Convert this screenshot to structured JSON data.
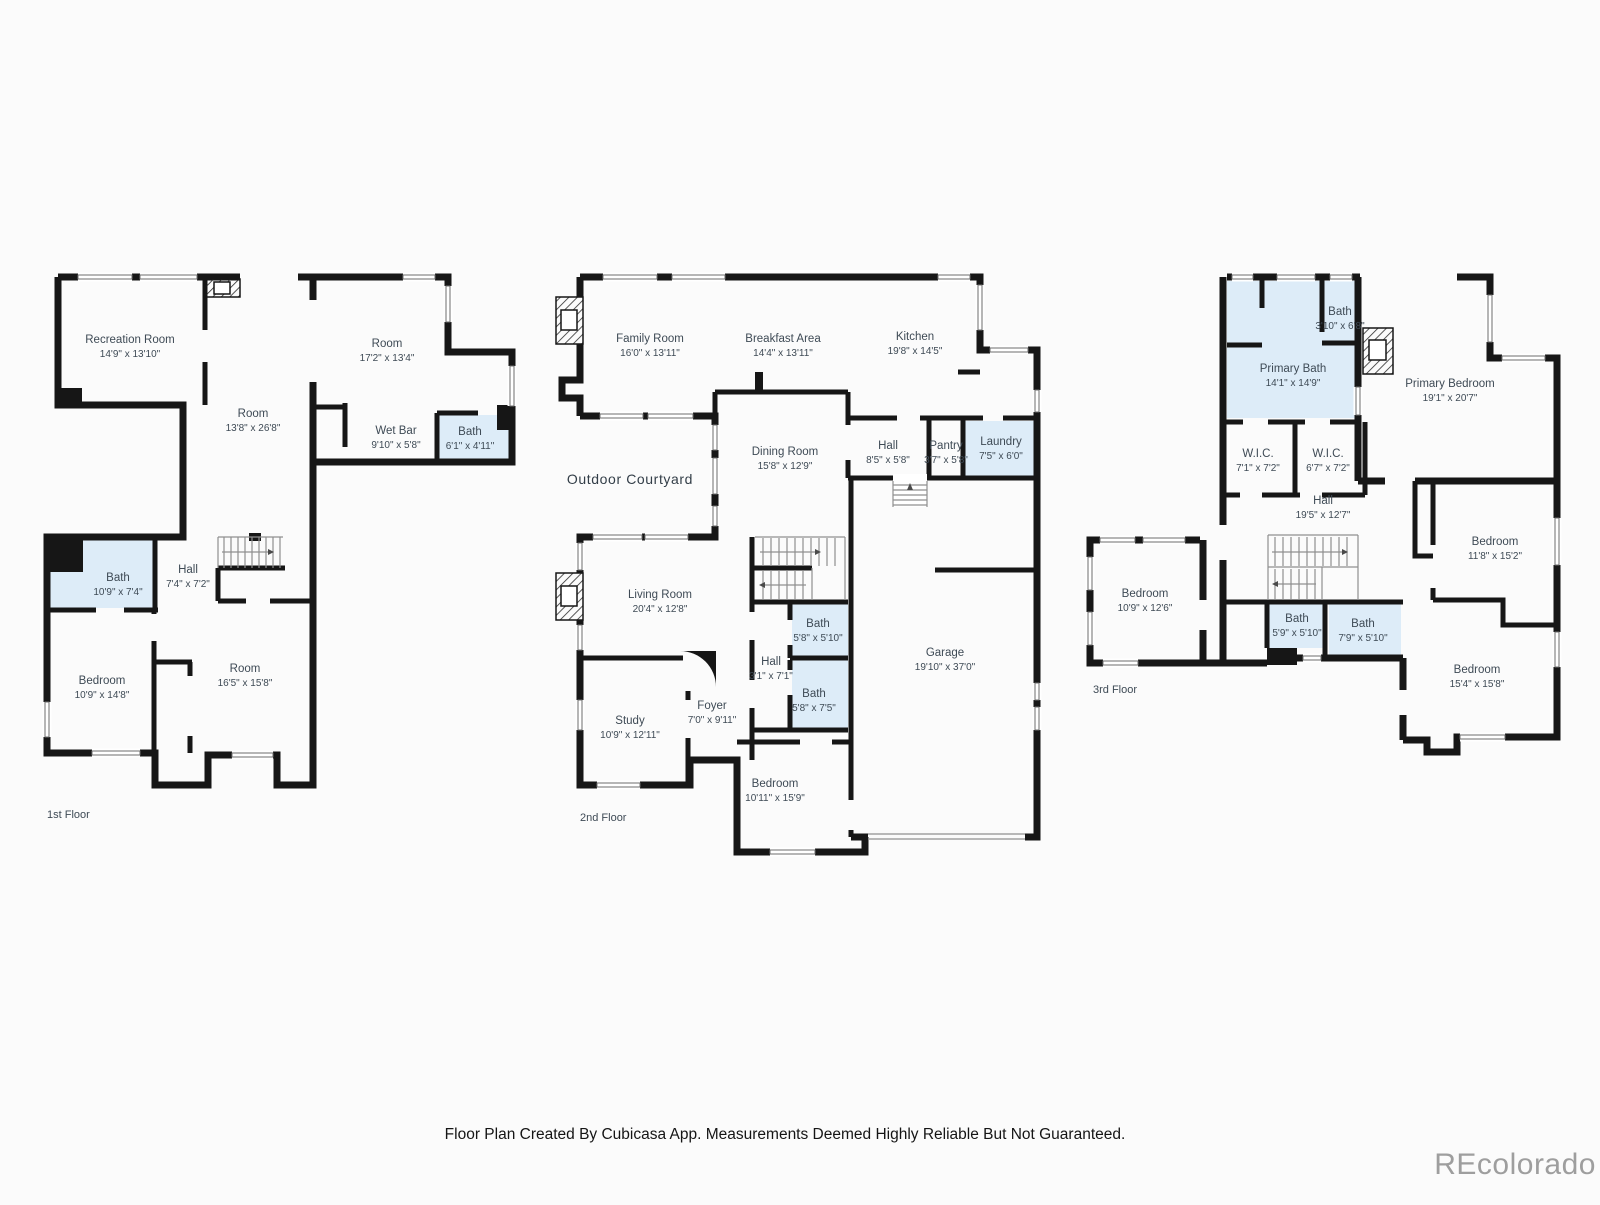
{
  "colors": {
    "wall": "#161616",
    "wet_room_fill": "#ddecf8",
    "label_text": "#3e4a55",
    "watermark_gray": "#9e9e9e",
    "background": "#fbfbfb"
  },
  "floors": [
    {
      "label": "1st Floor",
      "rooms": [
        {
          "name": "Recreation Room",
          "dims": "14'9\" x 13'10\""
        },
        {
          "name": "Room",
          "dims": "13'8\" x 26'8\""
        },
        {
          "name": "Room",
          "dims": "17'2\" x 13'4\""
        },
        {
          "name": "Wet Bar",
          "dims": "9'10\" x 5'8\""
        },
        {
          "name": "Bath",
          "dims": "6'1\" x 4'11\""
        },
        {
          "name": "Bath",
          "dims": "10'9\" x 7'4\""
        },
        {
          "name": "Hall",
          "dims": "7'4\" x 7'2\""
        },
        {
          "name": "Bedroom",
          "dims": "10'9\" x 14'8\""
        },
        {
          "name": "Room",
          "dims": "16'5\" x 15'8\""
        }
      ]
    },
    {
      "label": "2nd Floor",
      "rooms": [
        {
          "name": "Family Room",
          "dims": "16'0\" x 13'11\""
        },
        {
          "name": "Breakfast Area",
          "dims": "14'4\" x 13'11\""
        },
        {
          "name": "Kitchen",
          "dims": "19'8\" x 14'5\""
        },
        {
          "name": "Hall",
          "dims": "8'5\" x 5'8\""
        },
        {
          "name": "Pantry",
          "dims": "3'7\" x 5'8\""
        },
        {
          "name": "Laundry",
          "dims": "7'5\" x 6'0\""
        },
        {
          "name": "Outdoor Courtyard"
        },
        {
          "name": "Dining Room",
          "dims": "15'8\" x 12'9\""
        },
        {
          "name": "Living Room",
          "dims": "20'4\" x 12'8\""
        },
        {
          "name": "Bath",
          "dims": "5'8\" x 5'10\""
        },
        {
          "name": "Hall",
          "dims": "3'1\" x 7'1\""
        },
        {
          "name": "Bath",
          "dims": "5'8\" x 7'5\""
        },
        {
          "name": "Garage",
          "dims": "19'10\" x 37'0\""
        },
        {
          "name": "Study",
          "dims": "10'9\" x 12'11\""
        },
        {
          "name": "Foyer",
          "dims": "7'0\" x 9'11\""
        },
        {
          "name": "Bedroom",
          "dims": "10'11\" x 15'9\""
        }
      ]
    },
    {
      "label": "3rd Floor",
      "rooms": [
        {
          "name": "Bath",
          "dims": "3'10\" x 6'8\""
        },
        {
          "name": "Primary Bath",
          "dims": "14'1\" x 14'9\""
        },
        {
          "name": "Primary Bedroom",
          "dims": "19'1\" x 20'7\""
        },
        {
          "name": "W.I.C.",
          "dims": "7'1\" x 7'2\""
        },
        {
          "name": "W.I.C.",
          "dims": "6'7\" x 7'2\""
        },
        {
          "name": "Hall",
          "dims": "19'5\" x 12'7\""
        },
        {
          "name": "Bedroom",
          "dims": "10'9\" x 12'6\""
        },
        {
          "name": "Bedroom",
          "dims": "11'8\" x 15'2\""
        },
        {
          "name": "Bath",
          "dims": "5'9\" x 5'10\""
        },
        {
          "name": "Bath",
          "dims": "7'9\" x 5'10\""
        },
        {
          "name": "Bedroom",
          "dims": "15'4\" x 15'8\""
        }
      ]
    }
  ],
  "footer": {
    "caption": "Floor Plan Created By Cubicasa App. Measurements Deemed Highly Reliable But Not Guaranteed.",
    "watermark": "REcolorado"
  }
}
